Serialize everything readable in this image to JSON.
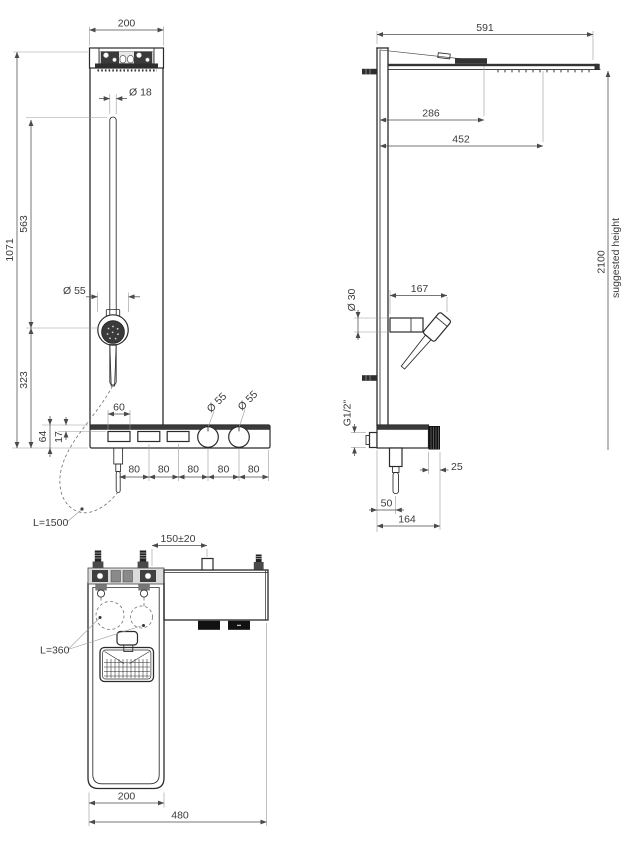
{
  "drawing": {
    "front_view": {
      "panel_width": "200",
      "slide_bar_diameter": "Ø 18",
      "total_height": "1071",
      "bar_height": "563",
      "lower_height": "323",
      "handshower_diameter": "Ø 55",
      "slot_width": "60",
      "shelf_height": "64",
      "slot_inset": "17",
      "knob1_diameter": "Ø 55",
      "knob2_diameter": "Ø 55",
      "spacings": [
        "80",
        "80",
        "80",
        "80",
        "80"
      ],
      "hose_length": "L=1500"
    },
    "side_view": {
      "head_arm_length": "591",
      "clamp_distance": "286",
      "mid_distance": "452",
      "suggested_height_value": "2100",
      "suggested_height_label": "suggested height",
      "holder_diameter": "Ø 30",
      "handshower_reach": "167",
      "thread_size": "G1/2\"",
      "knob_depth": "25",
      "hose_distance": "50",
      "shelf_depth": "164"
    },
    "plan_view": {
      "inlet_spacing": "150±20",
      "hose_tail_length": "L=360",
      "body_width": "200",
      "overall_width": "480"
    }
  }
}
